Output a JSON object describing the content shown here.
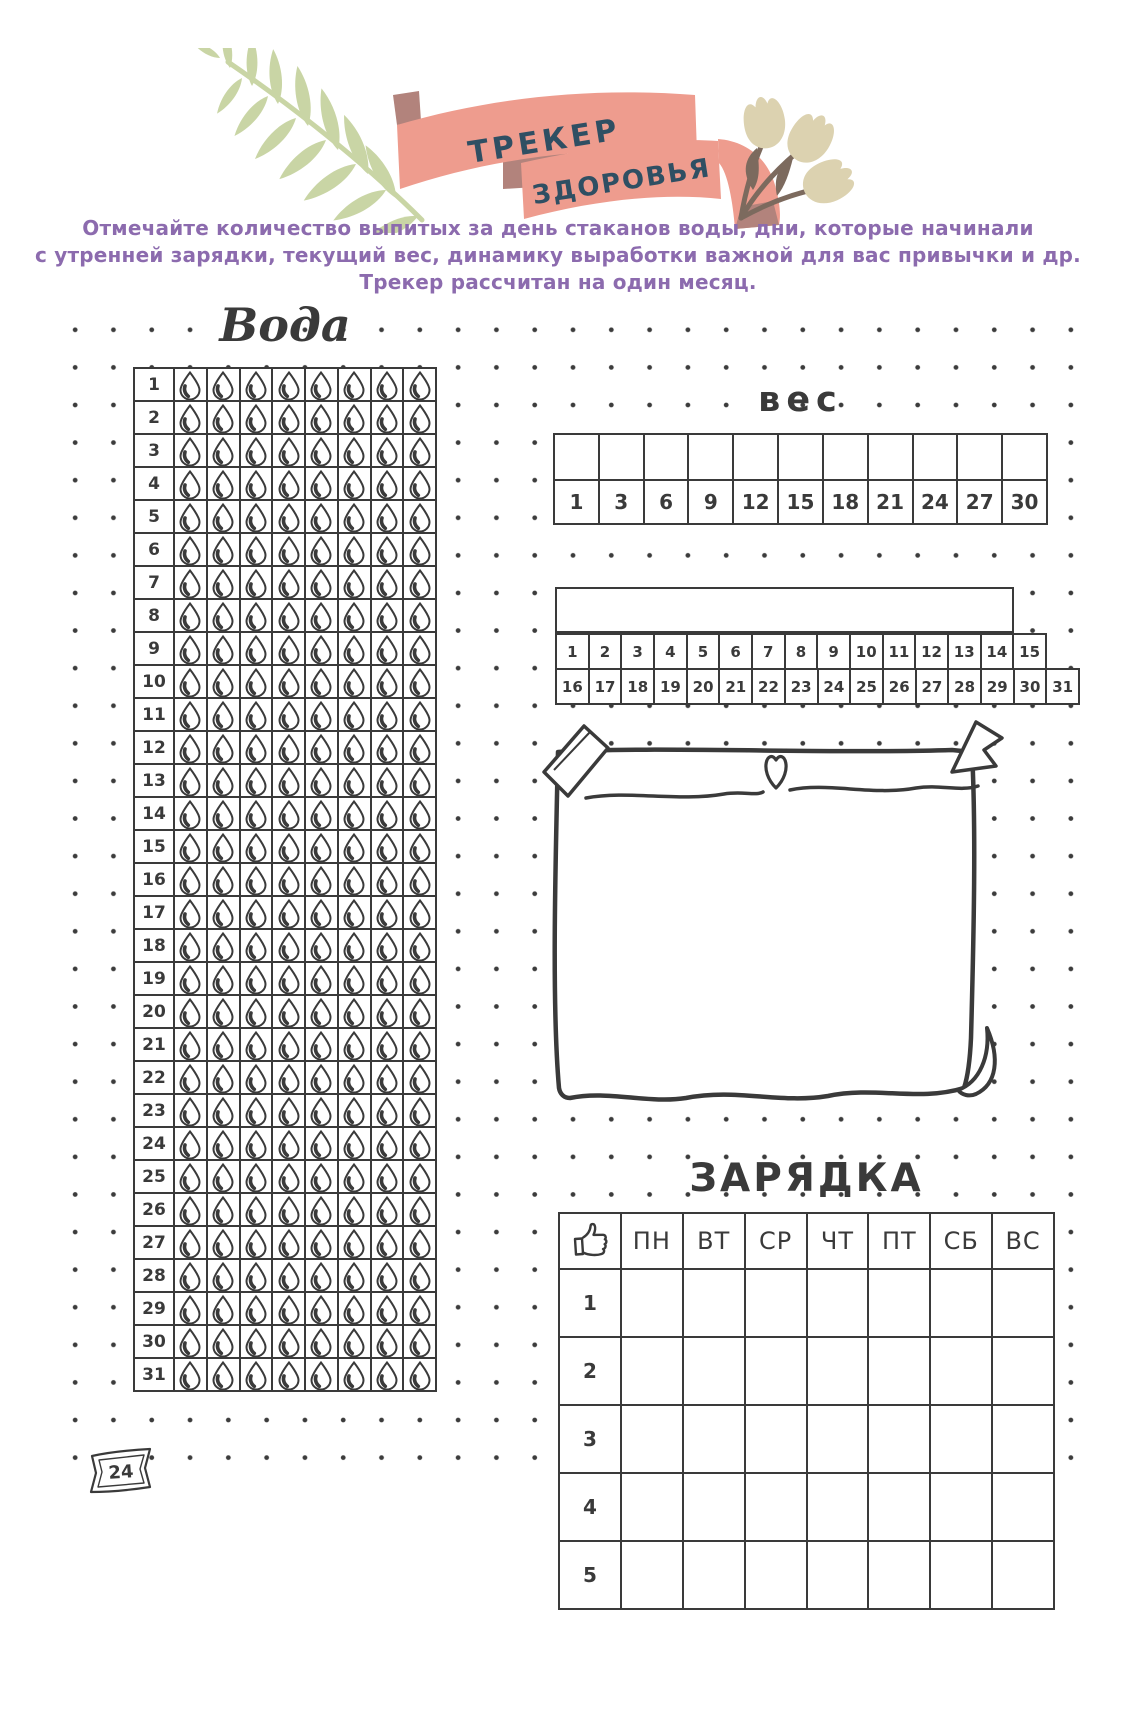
{
  "header": {
    "ribbon_line1": "ТРЕКЕР",
    "ribbon_line2": "ЗДОРОВЬЯ",
    "intro_line1": "Отмечайте количество выпитых за день стаканов воды, дни, которые начинали",
    "intro_line2": "с утренней зарядки, текущий вес, динамику выработки важной для вас привычки и др.",
    "intro_line3": "Трекер рассчитан на один месяц."
  },
  "water": {
    "title": "Вода",
    "drops_per_day": 8,
    "days": [
      "1",
      "2",
      "3",
      "4",
      "5",
      "6",
      "7",
      "8",
      "9",
      "10",
      "11",
      "12",
      "13",
      "14",
      "15",
      "16",
      "17",
      "18",
      "19",
      "20",
      "21",
      "22",
      "23",
      "24",
      "25",
      "26",
      "27",
      "28",
      "29",
      "30",
      "31"
    ]
  },
  "weight": {
    "title": "вес",
    "scale_labels": [
      "1",
      "3",
      "6",
      "9",
      "12",
      "15",
      "18",
      "21",
      "24",
      "27",
      "30"
    ],
    "days_top": [
      "1",
      "2",
      "3",
      "4",
      "5",
      "6",
      "7",
      "8",
      "9",
      "10",
      "11",
      "12",
      "13",
      "14",
      "15"
    ],
    "days_bottom": [
      "16",
      "17",
      "18",
      "19",
      "20",
      "21",
      "22",
      "23",
      "24",
      "25",
      "26",
      "27",
      "28",
      "29",
      "30",
      "31"
    ]
  },
  "exercise": {
    "title": "ЗАРЯДКА",
    "day_headers": [
      "ПН",
      "ВТ",
      "СР",
      "ЧТ",
      "ПТ",
      "СБ",
      "ВС"
    ],
    "row_labels": [
      "1",
      "2",
      "3",
      "4",
      "5"
    ]
  },
  "footer": {
    "page_number": "24"
  },
  "icons": [
    "water-drop-icon",
    "thumbs-up-icon",
    "heart-icon",
    "leaf-decoration",
    "tulip-decoration",
    "ribbon-banner",
    "washi-tape-icon",
    "page-curl-icon"
  ],
  "colors": {
    "ink": "#3A3A3A",
    "ribbon": "#EE9C8E",
    "ribbon-fold": "#B2837C",
    "ribbon-text": "#2F4F63",
    "leaf": "#C9D5A5",
    "tulip": "#DCD2B0",
    "tulip-stem": "#7C6A5E",
    "intro": "#8C6BAE"
  }
}
